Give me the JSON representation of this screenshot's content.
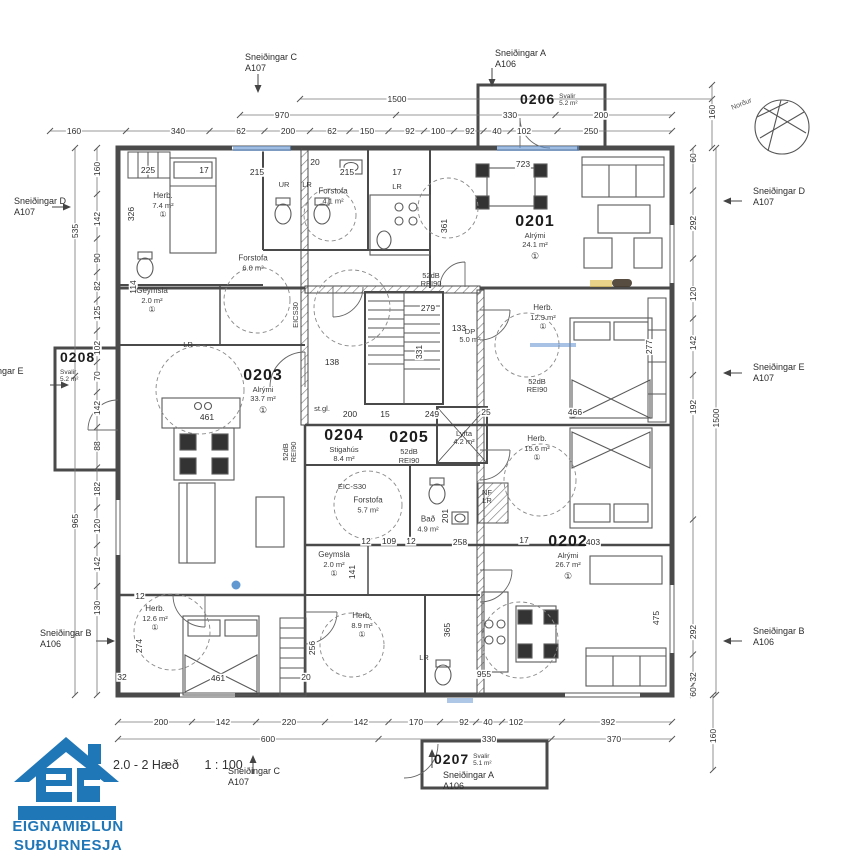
{
  "title": {
    "floor": "2.0 - 2 Hæð",
    "scale": "1 : 100"
  },
  "logo": {
    "line1": "EIGNAMIÐLUN",
    "line2": "SUÐURNESJA",
    "color": "#2077b8"
  },
  "compass": {
    "label": "Norður"
  },
  "sections": {
    "top_c": {
      "name": "Sneiðingar C",
      "sheet": "A107"
    },
    "top_a": {
      "name": "Sneiðingar A",
      "sheet": "A106"
    },
    "bottom_c": {
      "name": "Sneiðingar C",
      "sheet": "A107"
    },
    "bottom_a": {
      "name": "Sneiðingar A",
      "sheet": "A106"
    },
    "left_d": {
      "name": "Sneiðingar D",
      "sheet": "A107"
    },
    "left_e": {
      "name": "Sneiðingar E",
      "sheet": "A107"
    },
    "left_b": {
      "name": "Sneiðingar B",
      "sheet": "A106"
    },
    "right_d": {
      "name": "Sneiðingar D",
      "sheet": "A107"
    },
    "right_e": {
      "name": "Sneiðingar E",
      "sheet": "A107"
    },
    "right_b": {
      "name": "Sneiðingar B",
      "sheet": "A106"
    }
  },
  "units": {
    "u0201": {
      "id": "0201",
      "name": "Alrými",
      "area": "24.1 m²",
      "mark": "①"
    },
    "u0202": {
      "id": "0202",
      "name": "Alrými",
      "area": "26.7 m²",
      "mark": "①"
    },
    "u0203": {
      "id": "0203",
      "name": "Alrými",
      "area": "33.7 m²",
      "mark": "①"
    },
    "u0204": {
      "id": "0204",
      "name": "Stigahús",
      "area": "8.4 m²"
    },
    "u0205": {
      "id": "0205",
      "name": "52dB",
      "area": "REI90"
    },
    "u0206": {
      "id": "0206",
      "name": "Svalir",
      "area": "5.2 m²"
    },
    "u0207": {
      "id": "0207",
      "name": "Svalir",
      "area": "5.1 m²"
    },
    "u0208": {
      "id": "0208",
      "name": "Svalir",
      "area": "5.2 m²"
    }
  },
  "rooms": [
    {
      "n": "Herb.",
      "a": "7.4 m²",
      "x": 163,
      "y": 205,
      "m": "①"
    },
    {
      "n": "Geymsla",
      "a": "2.0 m²",
      "x": 152,
      "y": 300,
      "m": "①"
    },
    {
      "n": "Forstofa",
      "a": "6.0 m²",
      "x": 253,
      "y": 263
    },
    {
      "n": "Forstofa",
      "a": "4.1 m²",
      "x": 333,
      "y": 196
    },
    {
      "n": "Herb.",
      "a": "12.9 m²",
      "x": 543,
      "y": 317,
      "m": "①"
    },
    {
      "n": "Herb.",
      "a": "15.6 m²",
      "x": 537,
      "y": 448,
      "m": "①"
    },
    {
      "n": "Herb.",
      "a": "12.6 m²",
      "x": 155,
      "y": 618,
      "m": "①"
    },
    {
      "n": "Herb.",
      "a": "8.9 m²",
      "x": 362,
      "y": 625,
      "m": "①"
    },
    {
      "n": "Geymsla",
      "a": "2.0 m²",
      "x": 334,
      "y": 564,
      "m": "①"
    },
    {
      "n": "Forstofa",
      "a": "5.7 m²",
      "x": 368,
      "y": 505
    },
    {
      "n": "Bað",
      "a": "4.9 m²",
      "x": 428,
      "y": 524
    }
  ],
  "wall_tags": [
    {
      "v": "52dB",
      "v2": "REI90",
      "x": 431,
      "y": 280
    },
    {
      "v": "52dB",
      "v2": "REI90",
      "x": 537,
      "y": 386
    },
    {
      "v": "52dB",
      "v2": "REI90",
      "x": 290,
      "y": 452,
      "r": 1
    },
    {
      "v": "EICS30",
      "x": 296,
      "y": 315,
      "r": 1
    },
    {
      "v": "EIC-S30",
      "x": 352,
      "y": 487
    },
    {
      "v": "NF",
      "v2": "LR",
      "x": 487,
      "y": 497
    },
    {
      "v": "LR",
      "x": 188,
      "y": 345
    },
    {
      "v": "UR",
      "x": 284,
      "y": 185
    },
    {
      "v": "LR",
      "x": 307,
      "y": 185
    },
    {
      "v": "LR",
      "x": 397,
      "y": 187
    },
    {
      "v": "LR",
      "x": 424,
      "y": 658
    },
    {
      "v": "DP",
      "v2": "5.0 m²",
      "x": 470,
      "y": 336
    },
    {
      "v": "Lyfta",
      "v2": "4.2 m²",
      "x": 464,
      "y": 438
    },
    {
      "v": "st.gl.",
      "x": 322,
      "y": 409
    }
  ],
  "plan_dims": [
    {
      "v": "225",
      "x": 148,
      "y": 170
    },
    {
      "v": "17",
      "x": 204,
      "y": 170
    },
    {
      "v": "215",
      "x": 257,
      "y": 172
    },
    {
      "v": "20",
      "x": 315,
      "y": 162
    },
    {
      "v": "215",
      "x": 347,
      "y": 172
    },
    {
      "v": "17",
      "x": 397,
      "y": 172
    },
    {
      "v": "723",
      "x": 523,
      "y": 164
    },
    {
      "v": "361",
      "x": 444,
      "y": 226,
      "r": 1
    },
    {
      "v": "326",
      "x": 131,
      "y": 214,
      "r": 1
    },
    {
      "v": "114",
      "x": 133,
      "y": 287,
      "r": 1
    },
    {
      "v": "279",
      "x": 428,
      "y": 308
    },
    {
      "v": "133",
      "x": 459,
      "y": 328
    },
    {
      "v": "331",
      "x": 419,
      "y": 352,
      "r": 1
    },
    {
      "v": "138",
      "x": 332,
      "y": 362
    },
    {
      "v": "200",
      "x": 350,
      "y": 414
    },
    {
      "v": "15",
      "x": 385,
      "y": 414
    },
    {
      "v": "249",
      "x": 432,
      "y": 414
    },
    {
      "v": "25",
      "x": 486,
      "y": 412
    },
    {
      "v": "466",
      "x": 575,
      "y": 412
    },
    {
      "v": "277",
      "x": 649,
      "y": 347,
      "r": 1
    },
    {
      "v": "461",
      "x": 207,
      "y": 417
    },
    {
      "v": "12",
      "x": 366,
      "y": 541
    },
    {
      "v": "109",
      "x": 389,
      "y": 541
    },
    {
      "v": "12",
      "x": 411,
      "y": 541
    },
    {
      "v": "201",
      "x": 445,
      "y": 516,
      "r": 1
    },
    {
      "v": "258",
      "x": 460,
      "y": 542
    },
    {
      "v": "17",
      "x": 524,
      "y": 540
    },
    {
      "v": "403",
      "x": 593,
      "y": 542
    },
    {
      "v": "141",
      "x": 352,
      "y": 572,
      "r": 1
    },
    {
      "v": "256",
      "x": 312,
      "y": 648,
      "r": 1
    },
    {
      "v": "365",
      "x": 447,
      "y": 630,
      "r": 1
    },
    {
      "v": "475",
      "x": 656,
      "y": 618,
      "r": 1
    },
    {
      "v": "955",
      "x": 484,
      "y": 674
    },
    {
      "v": "274",
      "x": 139,
      "y": 646,
      "r": 1
    },
    {
      "v": "12",
      "x": 140,
      "y": 596
    },
    {
      "v": "32",
      "x": 122,
      "y": 677
    },
    {
      "v": "20",
      "x": 306,
      "y": 677
    },
    {
      "v": "461",
      "x": 218,
      "y": 678
    }
  ],
  "dim_rows": [
    {
      "o": "h",
      "y": 99,
      "x1": 300,
      "x2": 712,
      "labels": [
        {
          "v": "1500",
          "p": 397
        }
      ]
    },
    {
      "o": "h",
      "y": 115,
      "x1": 240,
      "x2": 672,
      "labels": [
        {
          "v": "970",
          "p": 282
        },
        {
          "v": "330",
          "p": 510
        },
        {
          "v": "200",
          "p": 601
        }
      ]
    },
    {
      "o": "h",
      "y": 131,
      "x1": 50,
      "x2": 672,
      "labels": [
        {
          "v": "160",
          "p": 74
        },
        {
          "v": "340",
          "p": 178
        },
        {
          "v": "62",
          "p": 241
        },
        {
          "v": "200",
          "p": 288
        },
        {
          "v": "62",
          "p": 332
        },
        {
          "v": "150",
          "p": 367
        },
        {
          "v": "92",
          "p": 410
        },
        {
          "v": "100",
          "p": 438
        },
        {
          "v": "92",
          "p": 470
        },
        {
          "v": "40",
          "p": 497
        },
        {
          "v": "102",
          "p": 524
        },
        {
          "v": "250",
          "p": 591
        }
      ]
    },
    {
      "o": "h",
      "y": 722,
      "x1": 118,
      "x2": 672,
      "labels": [
        {
          "v": "200",
          "p": 161
        },
        {
          "v": "142",
          "p": 223
        },
        {
          "v": "220",
          "p": 289
        },
        {
          "v": "142",
          "p": 361
        },
        {
          "v": "170",
          "p": 416
        },
        {
          "v": "92",
          "p": 464
        },
        {
          "v": "40",
          "p": 488
        },
        {
          "v": "102",
          "p": 516
        },
        {
          "v": "392",
          "p": 608
        }
      ]
    },
    {
      "o": "h",
      "y": 739,
      "x1": 118,
      "x2": 672,
      "labels": [
        {
          "v": "600",
          "p": 268
        },
        {
          "v": "330",
          "p": 489
        },
        {
          "v": "370",
          "p": 614
        }
      ]
    },
    {
      "o": "v",
      "x": 75,
      "y1": 148,
      "y2": 695,
      "labels": [
        {
          "v": "535",
          "p": 231
        },
        {
          "v": "965",
          "p": 521
        }
      ]
    },
    {
      "o": "v",
      "x": 97,
      "y1": 148,
      "y2": 695,
      "labels": [
        {
          "v": "160",
          "p": 169
        },
        {
          "v": "142",
          "p": 219
        },
        {
          "v": "90",
          "p": 258
        },
        {
          "v": "82",
          "p": 286
        },
        {
          "v": "125",
          "p": 313
        },
        {
          "v": "102",
          "p": 348
        },
        {
          "v": "70",
          "p": 376
        },
        {
          "v": "142",
          "p": 408
        },
        {
          "v": "88",
          "p": 446
        },
        {
          "v": "182",
          "p": 489
        },
        {
          "v": "120",
          "p": 526
        },
        {
          "v": "142",
          "p": 564
        },
        {
          "v": "130",
          "p": 608
        }
      ]
    },
    {
      "o": "v",
      "x": 693,
      "y1": 148,
      "y2": 695,
      "labels": [
        {
          "v": "60",
          "p": 158
        },
        {
          "v": "292",
          "p": 223
        },
        {
          "v": "120",
          "p": 294
        },
        {
          "v": "142",
          "p": 343
        },
        {
          "v": "192",
          "p": 407
        },
        {
          "v": "292",
          "p": 632
        },
        {
          "v": "32",
          "p": 677
        },
        {
          "v": "60",
          "p": 692
        }
      ]
    },
    {
      "o": "v",
      "x": 716,
      "y1": 148,
      "y2": 695,
      "labels": [
        {
          "v": "1500",
          "p": 418
        }
      ]
    },
    {
      "o": "v",
      "x": 712,
      "y1": 85,
      "y2": 148,
      "labels": [
        {
          "v": "160",
          "p": 112
        }
      ]
    },
    {
      "o": "v",
      "x": 713,
      "y1": 695,
      "y2": 770,
      "labels": [
        {
          "v": "160",
          "p": 736
        }
      ]
    }
  ]
}
